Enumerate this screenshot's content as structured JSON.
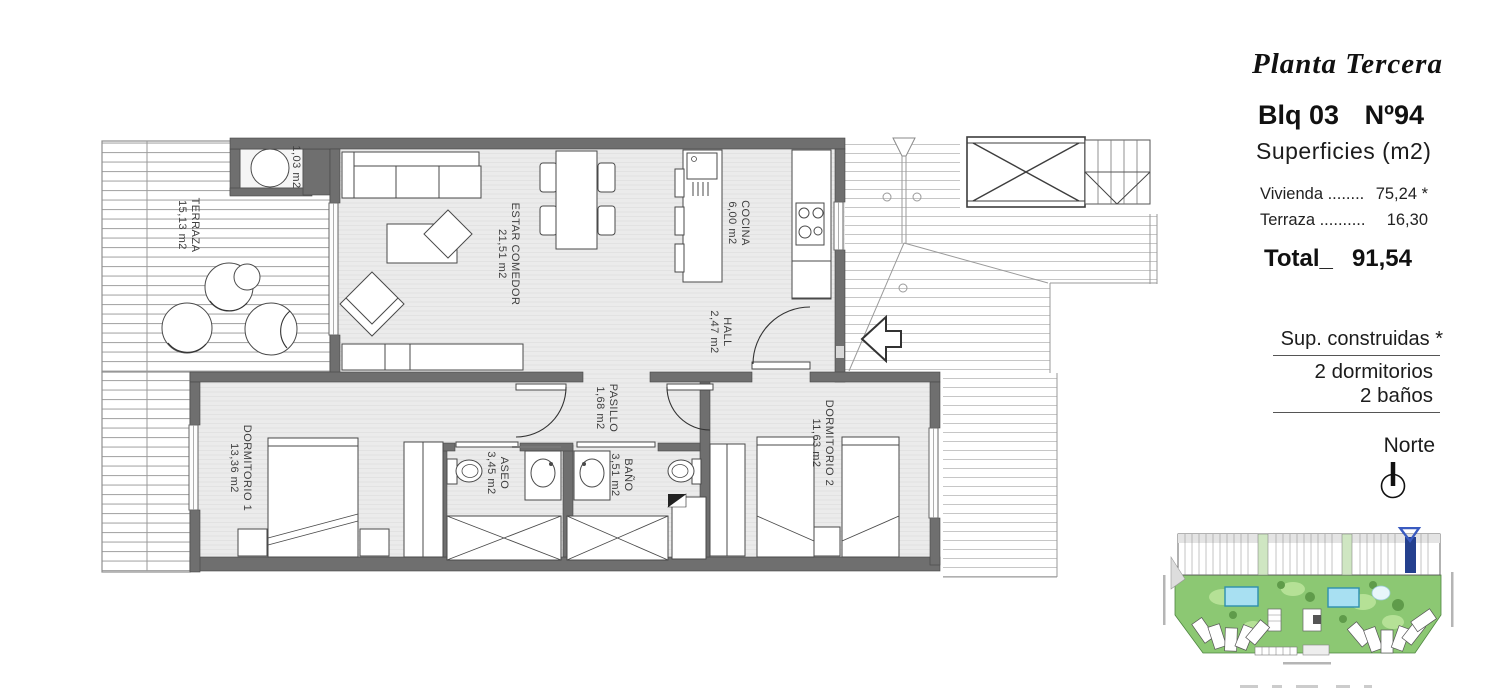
{
  "panel": {
    "plan_name": "Planta Tercera",
    "block_label": "Blq 03",
    "unit_label": "Nº94",
    "surfaces_heading": "Superficies (m2)",
    "rows": [
      {
        "label": "Vivienda ........",
        "value": "75,24 *"
      },
      {
        "label": "Terraza ..........",
        "value": "16,30"
      }
    ],
    "total_label": "Total_",
    "total_value": "91,54",
    "built_note": "Sup. construidas *",
    "bedrooms_line": "2 dormitorios",
    "bathrooms_line": "2 baños",
    "north_label": "Norte"
  },
  "rooms": {
    "terraza": {
      "name": "TERRAZA",
      "area": "15,13 m2"
    },
    "estar_comedor": {
      "name": "ESTAR COMEDOR",
      "area": "21,51 m2"
    },
    "cocina": {
      "name": "COCINA",
      "area": "6,00 m2"
    },
    "hall": {
      "name": "HALL",
      "area": "2,47 m2"
    },
    "pasillo": {
      "name": "PASILLO",
      "area": "1,68 m2"
    },
    "dormitorio1": {
      "name": "DORMITORIO 1",
      "area": "13,36 m2"
    },
    "aseo": {
      "name": "ASEO",
      "area": "3,45 m2"
    },
    "bano": {
      "name": "BAÑO",
      "area": "3,51 m2"
    },
    "dormitorio2": {
      "name": "DORMITORIO 2",
      "area": "11,63 m2"
    },
    "closet": {
      "area": "1,03 m2"
    }
  },
  "colors": {
    "wall": "#6f6f6f",
    "room_fill": "#ebebeb",
    "highlight_blue": "#24408e",
    "site_green": "#8cc873",
    "pool_blue": "#a8e0f2"
  }
}
